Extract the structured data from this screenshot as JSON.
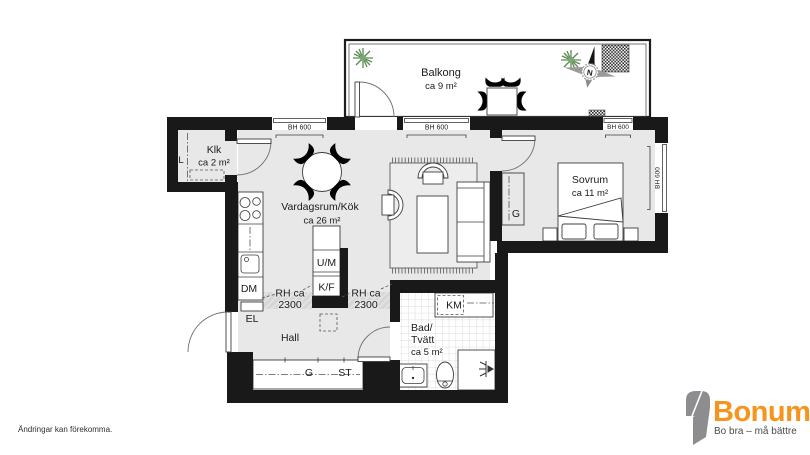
{
  "rooms": {
    "balcony": {
      "name": "Balkong",
      "area": "ca 9 m²"
    },
    "closet": {
      "name": "Klk",
      "area": "ca 2 m²"
    },
    "living_kitchen": {
      "name": "Vardagsrum/Kök",
      "area": "ca 26 m²"
    },
    "bedroom": {
      "name": "Sovrum",
      "area": "ca 11 m²"
    },
    "bath_laundry": {
      "name_line1": "Bad/",
      "name_line2": "Tvätt",
      "area": "ca 5 m²"
    },
    "hall": {
      "name": "Hall"
    }
  },
  "labels": {
    "window_height": "BH 600",
    "ceiling_height_line1": "RH ca",
    "ceiling_height_line2": "2300",
    "dishwasher": "DM",
    "oven_microwave": "U/M",
    "fridge_freezer": "K/F",
    "electrical": "EL",
    "washing_machine": "KM",
    "hall_wardrobe": "G",
    "cleaning_closet": "ST",
    "linen_closet": "L",
    "bedroom_wardrobe": "G",
    "compass_north": "N"
  },
  "footer": {
    "disclaimer": "Ändringar kan förekomma."
  },
  "logo": {
    "name": "Bonum",
    "tagline": "Bo bra – må bättre"
  },
  "colors": {
    "wall": "#191919",
    "floor": "#e8e8e8",
    "hatch_band": "#d7d7d7",
    "logo_orange": "#f7941d",
    "logo_gray": "#8d8d90",
    "plant_green": "#79a871"
  }
}
